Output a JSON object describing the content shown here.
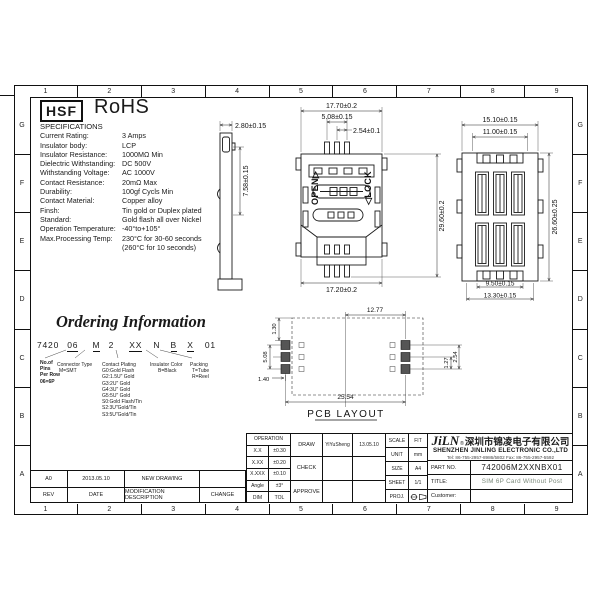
{
  "sheet": {
    "cols": [
      "1",
      "2",
      "3",
      "4",
      "5",
      "6",
      "7",
      "8",
      "9"
    ],
    "rows": [
      "G",
      "F",
      "E",
      "D",
      "C",
      "B",
      "A"
    ]
  },
  "header": {
    "hsf_label": "HSF",
    "rohs_label": "RoHS"
  },
  "specifications": {
    "title": "SPECIFICATIONS",
    "items": [
      {
        "label": "Current Rating:",
        "value": "3 Amps"
      },
      {
        "label": "Insulator body:",
        "value": "LCP"
      },
      {
        "label": "Insulator Resistance:",
        "value": "1000MΩ Min"
      },
      {
        "label": "Dielectric Withstanding:",
        "value": "DC 500V"
      },
      {
        "label": "Withstanding Voltage:",
        "value": "AC 1000V"
      },
      {
        "label": "Contact Resistance:",
        "value": "20mΩ Max"
      },
      {
        "label": "Durability:",
        "value": "100gf Cycls Min"
      },
      {
        "label": "Contact Material:",
        "value": "Copper alloy"
      },
      {
        "label": "Finsh:",
        "value": "Tin gold or Duplex plated"
      },
      {
        "label": "Standard:",
        "value": "Gold flash all over Nickel"
      },
      {
        "label": "Operation Temperature:",
        "value": "-40°to+105°"
      },
      {
        "label": "Max.Processing Temp:",
        "value": "230°C for 30-60 seconds"
      },
      {
        "label": "",
        "value": "(260°C for 10 seconds)"
      }
    ]
  },
  "ordering": {
    "title": "Ordering Information",
    "code": [
      "7420",
      "06",
      "M",
      "2",
      "XX",
      "N",
      "B",
      "X",
      "01"
    ],
    "pins": {
      "lines": [
        "No.of",
        "Pins",
        "Per Row",
        "06=6P"
      ]
    },
    "connector": {
      "title": "Connector Type",
      "value": "M=SMT"
    },
    "plating": {
      "title": "Contact Plating",
      "lines": [
        "G0:Gold Flash",
        "G2:1.5U\" Gold",
        "G3:2U\" Gold",
        "G4:3U\" Gold",
        "G5:5U\" Gold",
        "S0:Gold Flash/Tin",
        "S2:3U\"Gold/Tin",
        "S3:5U\"Gold/Tin"
      ]
    },
    "color": {
      "title": "Insulator Color",
      "value": "B=Black"
    },
    "packing": {
      "title": "Packing",
      "lines": [
        "T=Tube",
        "R=Reel"
      ]
    }
  },
  "views": {
    "side": {
      "dim_width": "2.80±0.15",
      "dim_height": "7.58±0.15"
    },
    "top": {
      "dim_width": "17.70±0.2",
      "dim_pin_span": "5.08±0.15",
      "dim_pitch": "2.54±0.1",
      "dim_height": "29.60±0.2",
      "dim_bottom_width": "17.20±0.2",
      "open_label": "OPEN▷",
      "lock_label": "◁LOCK"
    },
    "rear": {
      "dim_width": "15.10±0.15",
      "dim_inner_width": "11.00±0.15",
      "dim_height": "26.60±0.25",
      "dim_slot_width": "9.50±0.15",
      "dim_bottom_width": "13.30±0.15"
    },
    "pcb": {
      "label": "PCB LAYOUT",
      "dim_half": "12.77",
      "dim_top_offset": "1.30",
      "dim_pad_span": "5.08",
      "dim_pad_offset": "1.40",
      "dim_total": "25.54",
      "dim_half_pitch": "1.27",
      "dim_pitch": "2.54"
    }
  },
  "titleblock": {
    "revision": {
      "entry": {
        "rev": "A0",
        "date": "2013.05.10",
        "description": "NEW DRAWING",
        "change": ""
      },
      "headers": [
        "REV",
        "DATE",
        "MODIFICATION DESCRIPTION",
        "CHANGE"
      ]
    },
    "tolerance": {
      "title": "OPERATION",
      "rows": [
        [
          "X.X",
          "±0.30"
        ],
        [
          "X.XX",
          "±0.20"
        ],
        [
          "X.XXX",
          "±0.10"
        ],
        [
          "Angle",
          "±3°"
        ],
        [
          "DIM",
          "TOL"
        ]
      ]
    },
    "signoff": {
      "rows": [
        {
          "label": "DRAW",
          "name": "YiYuSheng",
          "date": "13.05.10"
        },
        {
          "label": "CHECK",
          "name": "",
          "date": ""
        },
        {
          "label": "APPROVE",
          "name": "",
          "date": ""
        }
      ]
    },
    "info": {
      "rows": [
        [
          "SCALE",
          "FIT"
        ],
        [
          "UNIT",
          "mm"
        ],
        [
          "SIZE",
          "A4"
        ],
        [
          "SHEET",
          "1/1"
        ]
      ],
      "proj_label": "PROJ."
    },
    "company": {
      "logo": "JiLN",
      "reg_mark": "®",
      "name_cn": "深圳市锦凌电子有限公司",
      "name_en": "SHENZHEN JINLING ELECTRONIC CO.,LTD",
      "contact": "Tel: 86-755-2957-8986/5802   Fax: 86-755-2957-5592",
      "part_label": "PART NO.",
      "part_no": "742006M2XXNBX01",
      "title_label": "TITLE:",
      "drawing_title": "SIM 6P Card Without Post",
      "customer_label": "Customer:"
    }
  }
}
